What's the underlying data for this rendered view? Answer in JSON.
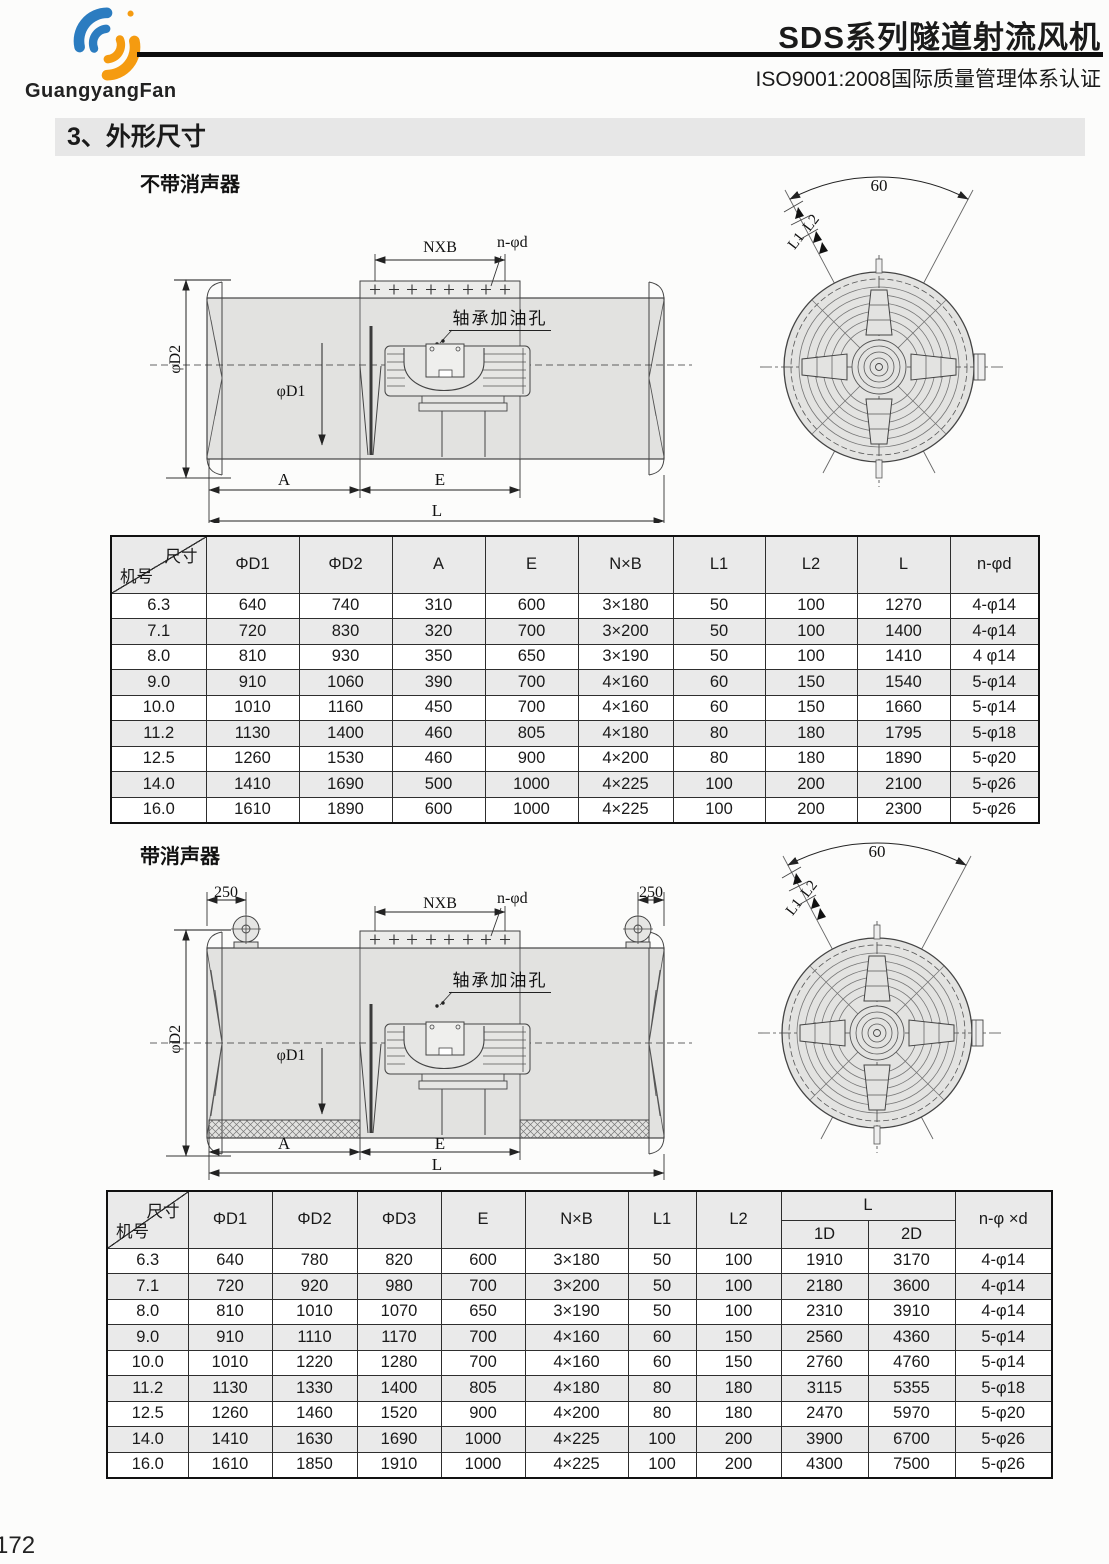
{
  "header": {
    "logo_text": "GuangyangFan",
    "title": "SDS系列隧道射流风机",
    "certification": "ISO9001:2008国际质量管理体系认证"
  },
  "section_title": "3、外形尺寸",
  "diagram_no_silencer": {
    "label": "不带消声器",
    "labels": {
      "nxb": "NXB",
      "n_phi_d": "n-φd",
      "bearing_hole": "轴承加油孔",
      "phi_d2": "φD2",
      "phi_d1": "φD1",
      "a": "A",
      "e": "E",
      "l": "L",
      "angle": "60",
      "l1": "L1",
      "l2": "L2"
    }
  },
  "table_no_silencer": {
    "corner_top": "尺寸",
    "corner_bottom": "机号",
    "columns": [
      "ΦD1",
      "ΦD2",
      "A",
      "E",
      "N×B",
      "L1",
      "L2",
      "L",
      "n-φd"
    ],
    "rows": [
      [
        "6.3",
        "640",
        "740",
        "310",
        "600",
        "3×180",
        "50",
        "100",
        "1270",
        "4-φ14"
      ],
      [
        "7.1",
        "720",
        "830",
        "320",
        "700",
        "3×200",
        "50",
        "100",
        "1400",
        "4-φ14"
      ],
      [
        "8.0",
        "810",
        "930",
        "350",
        "650",
        "3×190",
        "50",
        "100",
        "1410",
        "4 φ14"
      ],
      [
        "9.0",
        "910",
        "1060",
        "390",
        "700",
        "4×160",
        "60",
        "150",
        "1540",
        "5-φ14"
      ],
      [
        "10.0",
        "1010",
        "1160",
        "450",
        "700",
        "4×160",
        "60",
        "150",
        "1660",
        "5-φ14"
      ],
      [
        "11.2",
        "1130",
        "1400",
        "460",
        "805",
        "4×180",
        "80",
        "180",
        "1795",
        "5-φ18"
      ],
      [
        "12.5",
        "1260",
        "1530",
        "460",
        "900",
        "4×200",
        "80",
        "180",
        "1890",
        "5-φ20"
      ],
      [
        "14.0",
        "1410",
        "1690",
        "500",
        "1000",
        "4×225",
        "100",
        "200",
        "2100",
        "5-φ26"
      ],
      [
        "16.0",
        "1610",
        "1890",
        "600",
        "1000",
        "4×225",
        "100",
        "200",
        "2300",
        "5-φ26"
      ]
    ]
  },
  "diagram_silencer": {
    "label": "带消声器",
    "labels": {
      "left_250": "250",
      "right_250": "250",
      "nxb": "NXB",
      "n_phi_d": "n-φd",
      "bearing_hole": "轴承加油孔",
      "phi_d2": "φD2",
      "phi_d1": "φD1",
      "a": "A",
      "e": "E",
      "l": "L",
      "angle": "60",
      "l1": "L1",
      "l2": "L2"
    }
  },
  "table_silencer": {
    "corner_top": "尺寸",
    "corner_bottom": "机号",
    "columns_left": [
      "ΦD1",
      "ΦD2",
      "ΦD3",
      "E",
      "N×B",
      "L1",
      "L2"
    ],
    "l_group_label": "L",
    "l_sub_columns": [
      "1D",
      "2D"
    ],
    "last_column": "n-φ ×d",
    "rows": [
      [
        "6.3",
        "640",
        "780",
        "820",
        "600",
        "3×180",
        "50",
        "100",
        "1910",
        "3170",
        "4-φ14"
      ],
      [
        "7.1",
        "720",
        "920",
        "980",
        "700",
        "3×200",
        "50",
        "100",
        "2180",
        "3600",
        "4-φ14"
      ],
      [
        "8.0",
        "810",
        "1010",
        "1070",
        "650",
        "3×190",
        "50",
        "100",
        "2310",
        "3910",
        "4-φ14"
      ],
      [
        "9.0",
        "910",
        "1110",
        "1170",
        "700",
        "4×160",
        "60",
        "150",
        "2560",
        "4360",
        "5-φ14"
      ],
      [
        "10.0",
        "1010",
        "1220",
        "1280",
        "700",
        "4×160",
        "60",
        "150",
        "2760",
        "4760",
        "5-φ14"
      ],
      [
        "11.2",
        "1130",
        "1330",
        "1400",
        "805",
        "4×180",
        "80",
        "180",
        "3115",
        "5355",
        "5-φ18"
      ],
      [
        "12.5",
        "1260",
        "1460",
        "1520",
        "900",
        "4×200",
        "80",
        "180",
        "2470",
        "5970",
        "5-φ20"
      ],
      [
        "14.0",
        "1410",
        "1630",
        "1690",
        "1000",
        "4×225",
        "100",
        "200",
        "3900",
        "6700",
        "5-φ26"
      ],
      [
        "16.0",
        "1610",
        "1850",
        "1910",
        "1000",
        "4×225",
        "100",
        "200",
        "4300",
        "7500",
        "5-φ26"
      ]
    ]
  },
  "footer": {
    "page_number": "172"
  },
  "colors": {
    "logo_blue": "#2b7cc0",
    "logo_orange": "#f59b10",
    "section_bg": "#e7e7e7",
    "table_alt_row": "#eaeaea",
    "drawing_fill": "#e2e2e0"
  }
}
